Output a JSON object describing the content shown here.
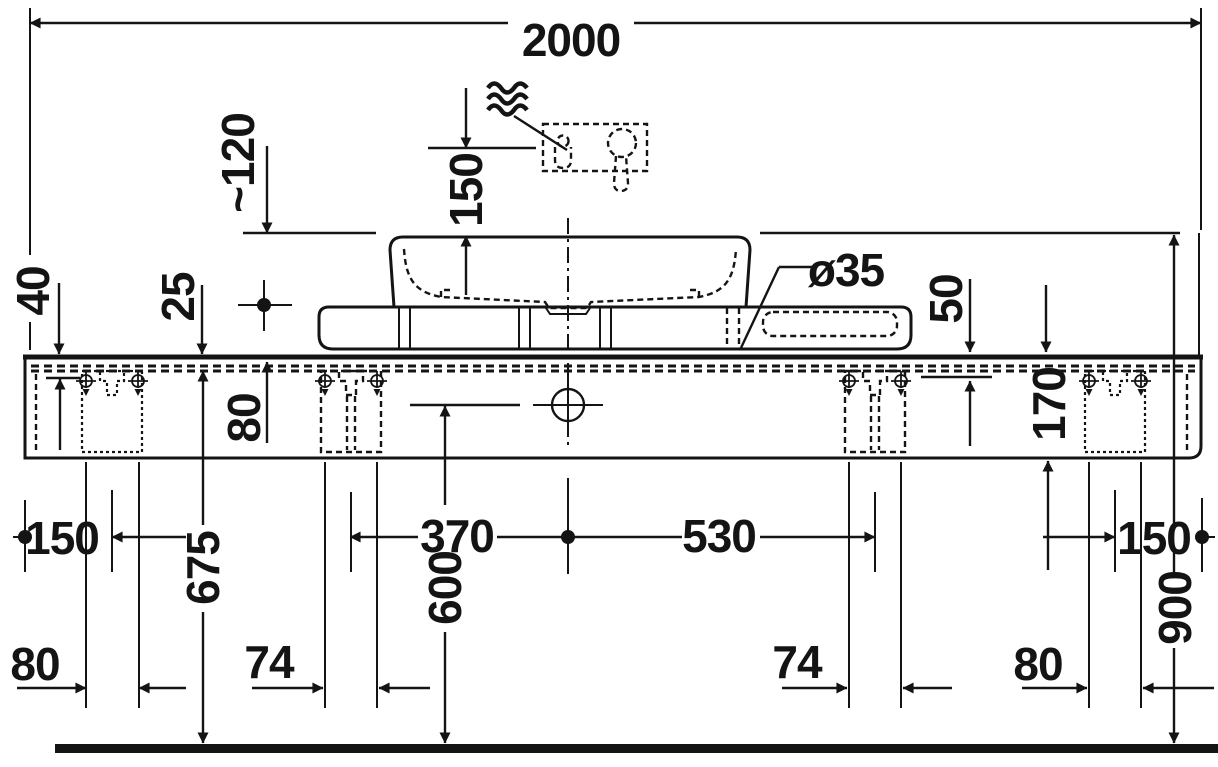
{
  "drawing": {
    "subject": "console-with-washbasin-front-elevation-technical-drawing",
    "colors": {
      "ink": "#141414",
      "background": "#ffffff"
    },
    "labels": {
      "overall_width": "2000",
      "spout_height_above_rim": "150",
      "spout_to_rim_clearance": "~120",
      "panel_thickness": "40",
      "rail_inset": "25",
      "tap_hole_diameter": "ø35",
      "edge_profile_height": "50",
      "frame_inner_height": "80",
      "console_height": "170",
      "left_end_to_bracket": "150",
      "center_to_left_bracket": "370",
      "center_to_right_bracket": "530",
      "right_end_to_bracket": "150",
      "floor_to_frame_underside": "675",
      "floor_to_drain_center": "600",
      "floor_to_basin_rim": "900",
      "screw_pitch_outer_left": "80",
      "screw_pitch_inner_left": "74",
      "screw_pitch_inner_right": "74",
      "screw_pitch_outer_right": "80"
    }
  }
}
